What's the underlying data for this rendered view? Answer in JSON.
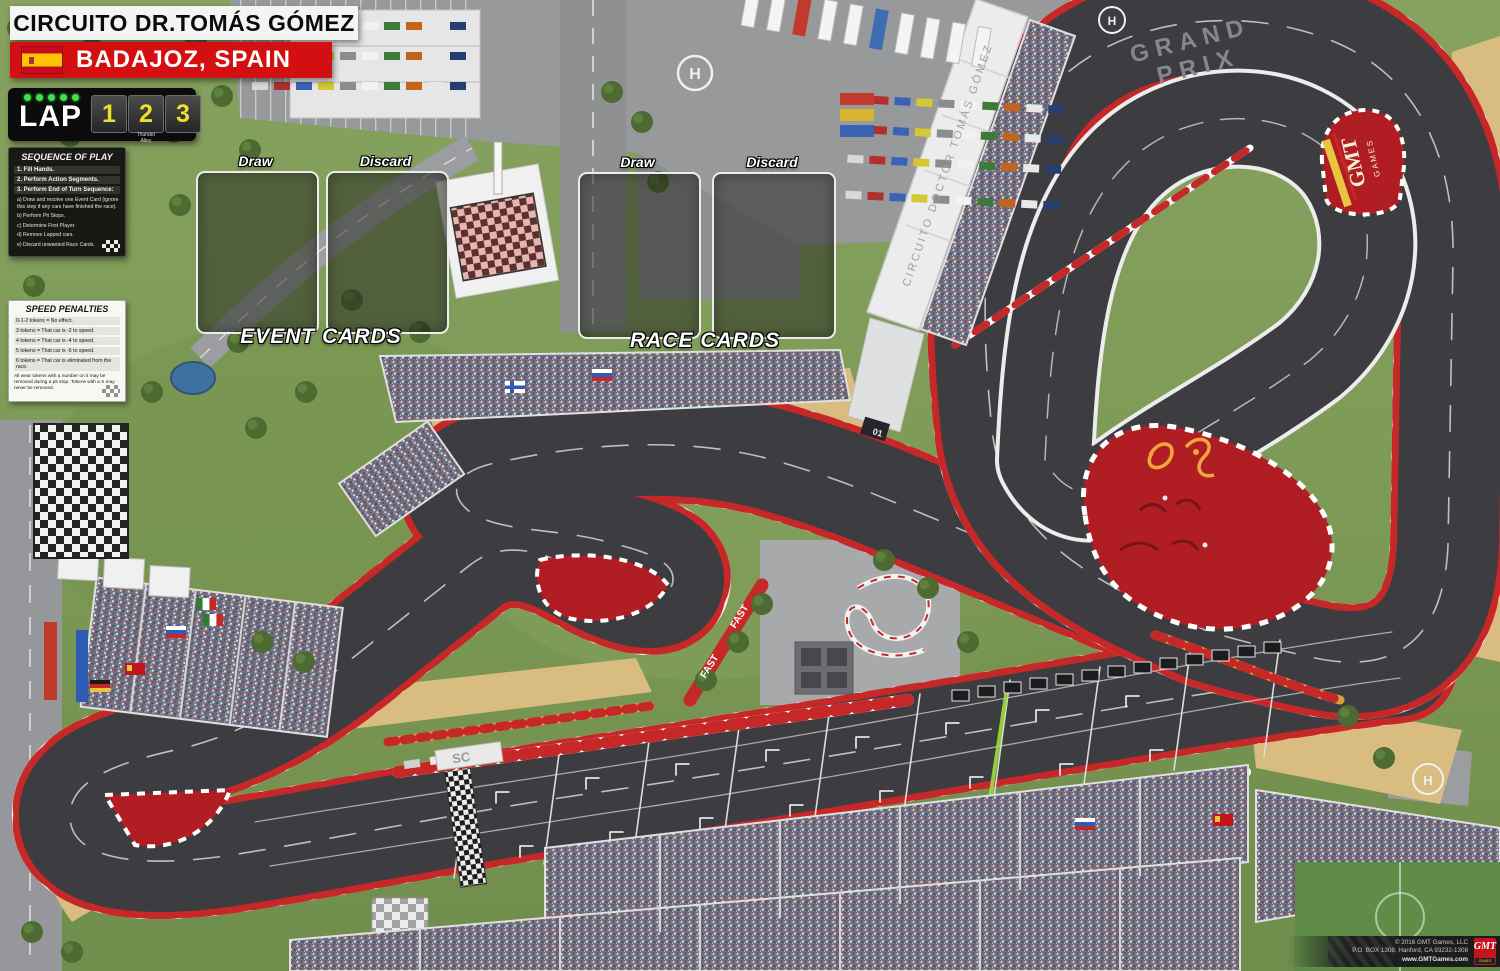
{
  "header": {
    "title": "CIRCUITO DR.TOMÁS GÓMEZ",
    "location": "BADAJOZ, SPAIN"
  },
  "lap_counter": {
    "label": "LAP",
    "laps": [
      "1",
      "2",
      "3"
    ],
    "brand_line1": "Thunder",
    "brand_line2": "Alley"
  },
  "sequence_of_play": {
    "title": "SEQUENCE OF PLAY",
    "steps": [
      "1. Fill Hands.",
      "2. Perform Action Segments.",
      "3. Perform End of Turn Sequence:"
    ],
    "substeps": [
      "a) Draw and resolve one Event Card (ignore this step if any cars have finished the race).",
      "b) Perform Pit Stops.",
      "c) Determine First Player.",
      "d) Remove Lapped cars.",
      "e) Discard unwanted Race Cards."
    ]
  },
  "speed_penalties": {
    "title": "SPEED PENALTIES",
    "rules": [
      "0-1-2 tokens = No effect.",
      "3 tokens = That car is -2 to speed.",
      "4 tokens = That car is -4 to speed.",
      "5 tokens = That car is -6 to speed.",
      "6 tokens = That car is eliminated from the race."
    ],
    "footnote": "All wear tokens with a number on it may be removed during a pit stop. Tokens with a X may never be removed."
  },
  "event_cards": {
    "draw_label": "Draw",
    "discard_label": "Discard",
    "zone_label": "EVENT CARDS"
  },
  "race_cards": {
    "draw_label": "Draw",
    "discard_label": "Discard",
    "zone_label": "RACE CARDS"
  },
  "track_labels": {
    "grand_prix_line1": "GRAND",
    "grand_prix_line2": "PRIX",
    "pit_roof": "CIRCUITO DOCTOR TOMÁS GÓMEZ",
    "fast_1": "FAST",
    "fast_2": "FAST",
    "gmt_infield_line1": "GMT",
    "gmt_infield_line2": "GAMES",
    "safety_car_board": "SC",
    "helipad": "H",
    "garage": "01"
  },
  "footer": {
    "copyright_line1": "© 2016 GMT Games, LLC",
    "copyright_line2": "P.O. BOX 1308, Hanford, CA 93232-1308",
    "copyright_line3": "www.GMTGames.com",
    "logo_line1": "GMT",
    "logo_line2": "GAMES"
  },
  "colors": {
    "grass": "#7d9a57",
    "asphalt": "#3d3d41",
    "curb_red": "#c62828",
    "infield_red": "#b01e24",
    "sand": "#d9bc80",
    "accent_red": "#d40f12",
    "lap_yellow": "#ecdf2e",
    "led_green": "#43e04c"
  }
}
